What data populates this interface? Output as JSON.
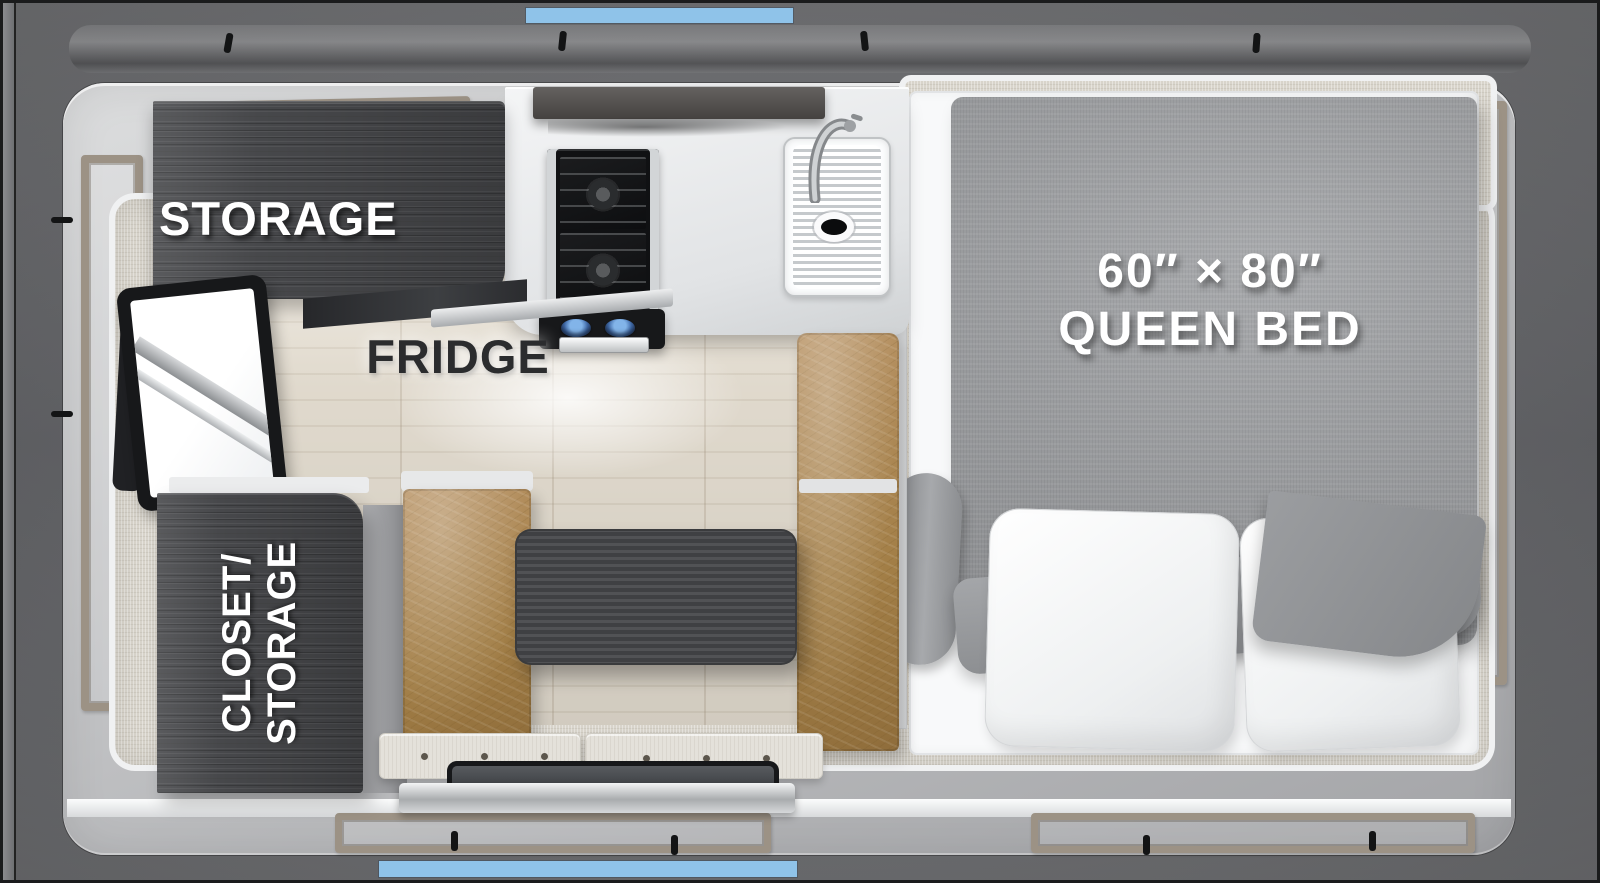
{
  "meta": {
    "title": "Truck camper floor plan",
    "view": "top-down floorplan rendering"
  },
  "labels": {
    "storage": "STORAGE",
    "fridge": "FRIDGE",
    "closet_lines": [
      "CLOSET/",
      "STORAGE"
    ],
    "bed_lines": [
      "60″ × 80″",
      "QUEEN BED"
    ]
  },
  "colors": {
    "accent_blue": "#8FC3E9",
    "outer_gray": "#67686B",
    "body_gray": "#C3C4C6",
    "window_taupe": "#9C9285",
    "interior_beige": "#D8D4CB",
    "floor_wood": "#E9E2D5",
    "cabinet_dark": "#47484B",
    "leather_brown": "#AC8955",
    "table_dark": "#48494C",
    "bedding_gray": "#9C9EA1"
  },
  "furniture": [
    "storage-cabinet",
    "fridge",
    "range-hood",
    "two-burner-cooktop",
    "sink-with-faucet",
    "tv",
    "closet-storage-cabinet",
    "l-shaped-dinette-bench",
    "dinette-table",
    "queen-bed-60x80",
    "two-pillows",
    "entry-door"
  ]
}
